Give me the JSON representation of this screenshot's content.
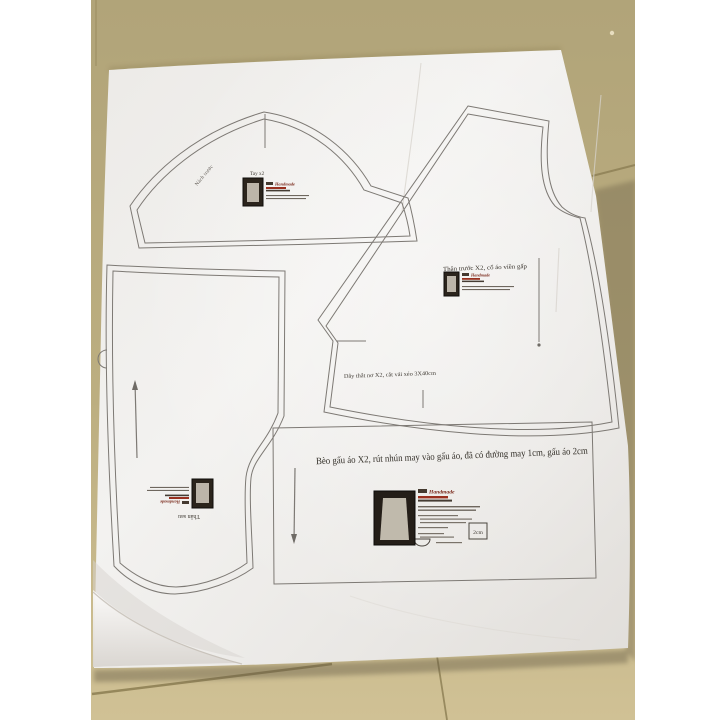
{
  "image": {
    "type": "photo",
    "description": "Paper sewing pattern sheet laid on a tan tiled floor, photographed from above with white side borders",
    "colors": {
      "floor": "#b1a479",
      "floor_light": "#d0c195",
      "grout": "#8f8156",
      "paper": "#efedea",
      "pattern_line": "#7d7974",
      "ink": "#3f3a33",
      "brand_red": "#8a2c1f",
      "letterbox": "#ffffff"
    }
  },
  "labels": {
    "sleeve_title": "Tay x2",
    "sleeve_edge_note": "Nách trước",
    "front_title": "Thân trước X2, cổ áo viền gấp",
    "tie_note": "Dây thắt nơ X2, cắt vải xéo 3X40cm",
    "ruffle_note": "Bèo gấu áo X2, rút nhún may vào gấu áo, đã có đường may 1cm, gấu áo 2cm",
    "back_title": "Thân sau",
    "scale_label": "2cm",
    "brand": "Handmade"
  }
}
